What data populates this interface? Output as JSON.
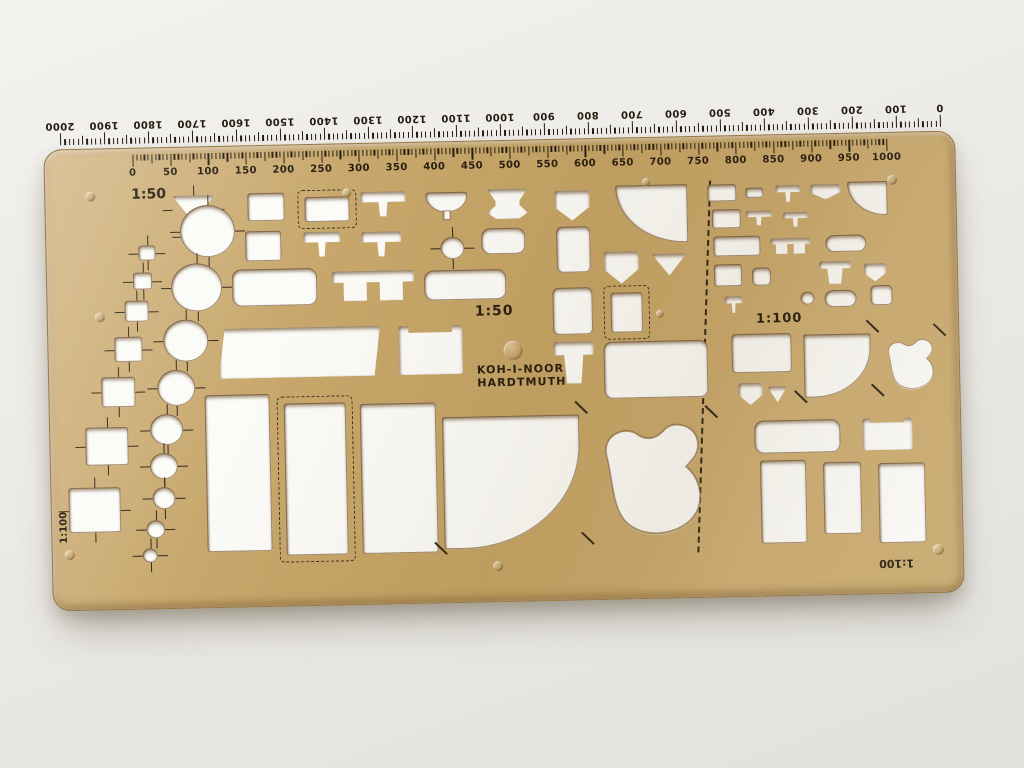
{
  "photo": {
    "background": "#edece8",
    "plate_color": "#c7a76b",
    "plate_highlight": "#d4b786",
    "plate_shadow": "#b08f52",
    "print_color": "#241c10",
    "hole_color": "#fbfbf8",
    "edge_color": "#6e4d22"
  },
  "brand": {
    "line1": "KOH-I-NOOR",
    "line2": "HARDTMUTH"
  },
  "labels": {
    "scale_50": "1:50",
    "scale_100": "1:100"
  },
  "top_ruler": {
    "scale": "1:50",
    "labels": [
      "0",
      "50",
      "100",
      "150",
      "200",
      "250",
      "300",
      "350",
      "400",
      "450",
      "500",
      "550",
      "600",
      "650",
      "700",
      "750",
      "800",
      "850",
      "900",
      "950",
      "1000"
    ]
  },
  "bottom_ruler": {
    "scale": "1:100",
    "labels": [
      "2000",
      "1900",
      "1800",
      "1700",
      "1600",
      "1500",
      "1400",
      "1300",
      "1200",
      "1100",
      "1000",
      "900",
      "800",
      "700",
      "600",
      "500",
      "400",
      "300",
      "200",
      "100",
      "0"
    ]
  },
  "shapes": [
    {
      "n": "triangle-large",
      "t": "tri-down",
      "x": 127,
      "y": 48,
      "w": 42,
      "h": 27,
      "ticks": true
    },
    {
      "n": "triangle-small",
      "t": "tri-down",
      "x": 136,
      "y": 80,
      "w": 26,
      "h": 17,
      "ticks": true
    },
    {
      "n": "square-1",
      "t": "rect",
      "x": 92,
      "y": 97,
      "w": 17,
      "h": 15,
      "ticks": true
    },
    {
      "n": "square-2",
      "t": "rect",
      "x": 86,
      "y": 124,
      "w": 19,
      "h": 17,
      "ticks": true
    },
    {
      "n": "square-3",
      "t": "rect",
      "x": 77,
      "y": 152,
      "w": 24,
      "h": 21,
      "ticks": true
    },
    {
      "n": "square-4",
      "t": "rect",
      "x": 66,
      "y": 188,
      "w": 28,
      "h": 25,
      "ticks": true
    },
    {
      "n": "square-5",
      "t": "rect",
      "x": 52,
      "y": 228,
      "w": 34,
      "h": 30,
      "ticks": true
    },
    {
      "n": "square-6",
      "t": "rect",
      "x": 35,
      "y": 278,
      "w": 43,
      "h": 38,
      "ticks": true
    },
    {
      "n": "square-7",
      "t": "rect",
      "x": 17,
      "y": 338,
      "w": 52,
      "h": 45,
      "ticks": true
    },
    {
      "n": "circle-1",
      "t": "circle",
      "x": 134,
      "y": 58,
      "w": 55,
      "h": 52,
      "ticks": true
    },
    {
      "n": "circle-2",
      "t": "circle",
      "x": 124,
      "y": 116,
      "w": 51,
      "h": 48,
      "ticks": true
    },
    {
      "n": "circle-3",
      "t": "circle",
      "x": 115,
      "y": 172,
      "w": 45,
      "h": 42,
      "ticks": true
    },
    {
      "n": "circle-4",
      "t": "circle",
      "x": 108,
      "y": 222,
      "w": 38,
      "h": 36,
      "ticks": true
    },
    {
      "n": "circle-5",
      "t": "circle",
      "x": 100,
      "y": 266,
      "w": 33,
      "h": 31,
      "ticks": true
    },
    {
      "n": "circle-6",
      "t": "circle",
      "x": 99,
      "y": 305,
      "w": 28,
      "h": 26,
      "ticks": true
    },
    {
      "n": "circle-7",
      "t": "circle",
      "x": 101,
      "y": 339,
      "w": 23,
      "h": 22,
      "ticks": true
    },
    {
      "n": "circle-8",
      "t": "circle",
      "x": 94,
      "y": 372,
      "w": 19,
      "h": 18,
      "ticks": true
    },
    {
      "n": "circle-9",
      "t": "circle",
      "x": 90,
      "y": 400,
      "w": 15,
      "h": 14,
      "ticks": true
    },
    {
      "n": "table-rect",
      "t": "rect",
      "x": 202,
      "y": 47,
      "w": 37,
      "h": 28
    },
    {
      "n": "crib-dashed",
      "t": "rect",
      "x": 259,
      "y": 52,
      "w": 45,
      "h": 25,
      "dash": true
    },
    {
      "n": "washbasin-1",
      "t": "sink",
      "x": 315,
      "y": 48,
      "w": 45,
      "h": 25
    },
    {
      "n": "washbasin-round",
      "t": "basin",
      "x": 380,
      "y": 50,
      "w": 42,
      "h": 20
    },
    {
      "n": "urinal",
      "t": "urinal",
      "x": 442,
      "y": 48,
      "w": 40,
      "h": 30
    },
    {
      "n": "pentagon-1",
      "t": "pent-down",
      "x": 509,
      "y": 51,
      "w": 35,
      "h": 30
    },
    {
      "n": "door-quarter",
      "t": "quarter-bl",
      "x": 570,
      "y": 47,
      "w": 72,
      "h": 58
    },
    {
      "n": "bench-2",
      "t": "rect",
      "x": 199,
      "y": 85,
      "w": 36,
      "h": 30
    },
    {
      "n": "washbasin-2",
      "t": "sink",
      "x": 257,
      "y": 87,
      "w": 37,
      "h": 25
    },
    {
      "n": "washbasin-3",
      "t": "sink",
      "x": 315,
      "y": 88,
      "w": 40,
      "h": 25
    },
    {
      "n": "round-table",
      "t": "circle",
      "x": 394,
      "y": 95,
      "w": 24,
      "h": 22,
      "ticks": true
    },
    {
      "n": "tub-small",
      "t": "tub",
      "x": 435,
      "y": 87,
      "w": 44,
      "h": 26
    },
    {
      "n": "cabinet-tall",
      "t": "rect",
      "x": 510,
      "y": 87,
      "w": 34,
      "h": 46,
      "r": "6px"
    },
    {
      "n": "pentagon-2",
      "t": "pent-down",
      "x": 557,
      "y": 113,
      "w": 35,
      "h": 32
    },
    {
      "n": "triangle-3",
      "t": "tri-down",
      "x": 605,
      "y": 116,
      "w": 35,
      "h": 22
    },
    {
      "n": "bathtub-1",
      "t": "tub",
      "x": 185,
      "y": 123,
      "w": 85,
      "h": 37
    },
    {
      "n": "double-washbasin",
      "t": "sink2",
      "x": 285,
      "y": 127,
      "w": 82,
      "h": 30
    },
    {
      "n": "bathtub-2",
      "t": "tub",
      "x": 377,
      "y": 128,
      "w": 82,
      "h": 30
    },
    {
      "n": "table-trapezoid",
      "t": "trap",
      "x": 170,
      "y": 182,
      "w": 162,
      "h": 50
    },
    {
      "n": "armchair",
      "t": "chair",
      "x": 350,
      "y": 183,
      "w": 64,
      "h": 49
    },
    {
      "n": "cabinet-2",
      "t": "rect",
      "x": 505,
      "y": 148,
      "w": 40,
      "h": 47,
      "r": "6px"
    },
    {
      "n": "square-dashed",
      "t": "rect",
      "x": 563,
      "y": 154,
      "w": 32,
      "h": 40,
      "dash": true
    },
    {
      "n": "toilet-1",
      "t": "toilet",
      "x": 505,
      "y": 202,
      "w": 40,
      "h": 42
    },
    {
      "n": "table-large",
      "t": "rect",
      "x": 555,
      "y": 203,
      "w": 104,
      "h": 57,
      "r": "8px"
    },
    {
      "n": "bed-large",
      "t": "rect",
      "x": 155,
      "y": 248,
      "w": 65,
      "h": 157
    },
    {
      "n": "bed-dashed",
      "t": "rect",
      "x": 234,
      "y": 258,
      "w": 62,
      "h": 152,
      "dash": true
    },
    {
      "n": "bed-wide",
      "t": "rect",
      "x": 310,
      "y": 260,
      "w": 76,
      "h": 150
    },
    {
      "n": "door-swing-large",
      "t": "door",
      "x": 392,
      "y": 275,
      "w": 137,
      "h": 132,
      "diag": true
    },
    {
      "n": "grand-piano",
      "t": "piano",
      "x": 539,
      "y": 282,
      "w": 120,
      "h": 118,
      "diag": true
    },
    {
      "n": "table-100-1",
      "t": "rect",
      "x": 662,
      "y": 48,
      "w": 29,
      "h": 17
    },
    {
      "n": "table-100-2",
      "t": "rect",
      "x": 700,
      "y": 52,
      "w": 18,
      "h": 10
    },
    {
      "n": "washbasin-100-1",
      "t": "sink",
      "x": 730,
      "y": 50,
      "w": 25,
      "h": 17
    },
    {
      "n": "pentagon-100-1",
      "t": "pent-down",
      "x": 765,
      "y": 50,
      "w": 30,
      "h": 15
    },
    {
      "n": "door-quarter-100",
      "t": "quarter-bl",
      "x": 802,
      "y": 48,
      "w": 40,
      "h": 34
    },
    {
      "n": "table-100-3",
      "t": "rect",
      "x": 666,
      "y": 73,
      "w": 29,
      "h": 19
    },
    {
      "n": "washbasin-100-2",
      "t": "sink",
      "x": 700,
      "y": 75,
      "w": 26,
      "h": 15
    },
    {
      "n": "washbasin-100-3",
      "t": "sink",
      "x": 737,
      "y": 77,
      "w": 25,
      "h": 15
    },
    {
      "n": "table-100-4",
      "t": "rect",
      "x": 667,
      "y": 100,
      "w": 47,
      "h": 20
    },
    {
      "n": "double-washbasin-100",
      "t": "sink2",
      "x": 724,
      "y": 103,
      "w": 40,
      "h": 16
    },
    {
      "n": "bathtub-100-1",
      "t": "tub",
      "x": 779,
      "y": 101,
      "w": 41,
      "h": 17
    },
    {
      "n": "table-100-5",
      "t": "rect",
      "x": 667,
      "y": 128,
      "w": 28,
      "h": 22
    },
    {
      "n": "stool-100",
      "t": "rect",
      "x": 705,
      "y": 132,
      "w": 19,
      "h": 18,
      "r": "5px"
    },
    {
      "n": "toilet-100",
      "t": "toilet",
      "x": 772,
      "y": 127,
      "w": 32,
      "h": 23
    },
    {
      "n": "pentagon-100-2",
      "t": "pent-down",
      "x": 817,
      "y": 130,
      "w": 22,
      "h": 18
    },
    {
      "n": "washbasin-100-4",
      "t": "sink",
      "x": 677,
      "y": 160,
      "w": 18,
      "h": 17
    },
    {
      "n": "round-table-100",
      "t": "circle",
      "x": 753,
      "y": 157,
      "w": 14,
      "h": 13
    },
    {
      "n": "bathtub-100-2",
      "t": "tub",
      "x": 777,
      "y": 156,
      "w": 32,
      "h": 17
    },
    {
      "n": "cabinet-100",
      "t": "rect",
      "x": 823,
      "y": 152,
      "w": 22,
      "h": 20,
      "r": "5px"
    },
    {
      "n": "table-100-6",
      "t": "rect",
      "x": 683,
      "y": 198,
      "w": 60,
      "h": 39,
      "r": "4px"
    },
    {
      "n": "door-swing-100",
      "t": "door",
      "x": 755,
      "y": 200,
      "w": 67,
      "h": 63,
      "diag": true
    },
    {
      "n": "grand-piano-100",
      "t": "piano",
      "x": 832,
      "y": 205,
      "w": 57,
      "h": 53,
      "diag": true
    },
    {
      "n": "pentagon-100-3",
      "t": "pent-down",
      "x": 689,
      "y": 247,
      "w": 24,
      "h": 22
    },
    {
      "n": "triangle-100",
      "t": "tri-down",
      "x": 718,
      "y": 251,
      "w": 20,
      "h": 16
    },
    {
      "n": "bathtub-100-3",
      "t": "tub",
      "x": 704,
      "y": 285,
      "w": 86,
      "h": 33
    },
    {
      "n": "sink-unit-100",
      "t": "chair",
      "x": 812,
      "y": 285,
      "w": 50,
      "h": 32
    },
    {
      "n": "bed-100-1",
      "t": "rect",
      "x": 709,
      "y": 325,
      "w": 46,
      "h": 83
    },
    {
      "n": "bed-100-2",
      "t": "rect",
      "x": 772,
      "y": 328,
      "w": 38,
      "h": 72
    },
    {
      "n": "bed-100-3",
      "t": "rect",
      "x": 827,
      "y": 330,
      "w": 47,
      "h": 80
    }
  ],
  "rivets": [
    {
      "x": 40,
      "y": 42,
      "d": 10
    },
    {
      "x": 297,
      "y": 44,
      "d": 9
    },
    {
      "x": 597,
      "y": 40,
      "d": 8
    },
    {
      "x": 842,
      "y": 42,
      "d": 10
    },
    {
      "x": 47,
      "y": 163,
      "d": 10
    },
    {
      "x": 608,
      "y": 172,
      "d": 8
    },
    {
      "x": 455,
      "y": 200,
      "d": 19
    },
    {
      "x": 12,
      "y": 400,
      "d": 10
    },
    {
      "x": 440,
      "y": 420,
      "d": 10
    },
    {
      "x": 880,
      "y": 412,
      "d": 11
    }
  ]
}
